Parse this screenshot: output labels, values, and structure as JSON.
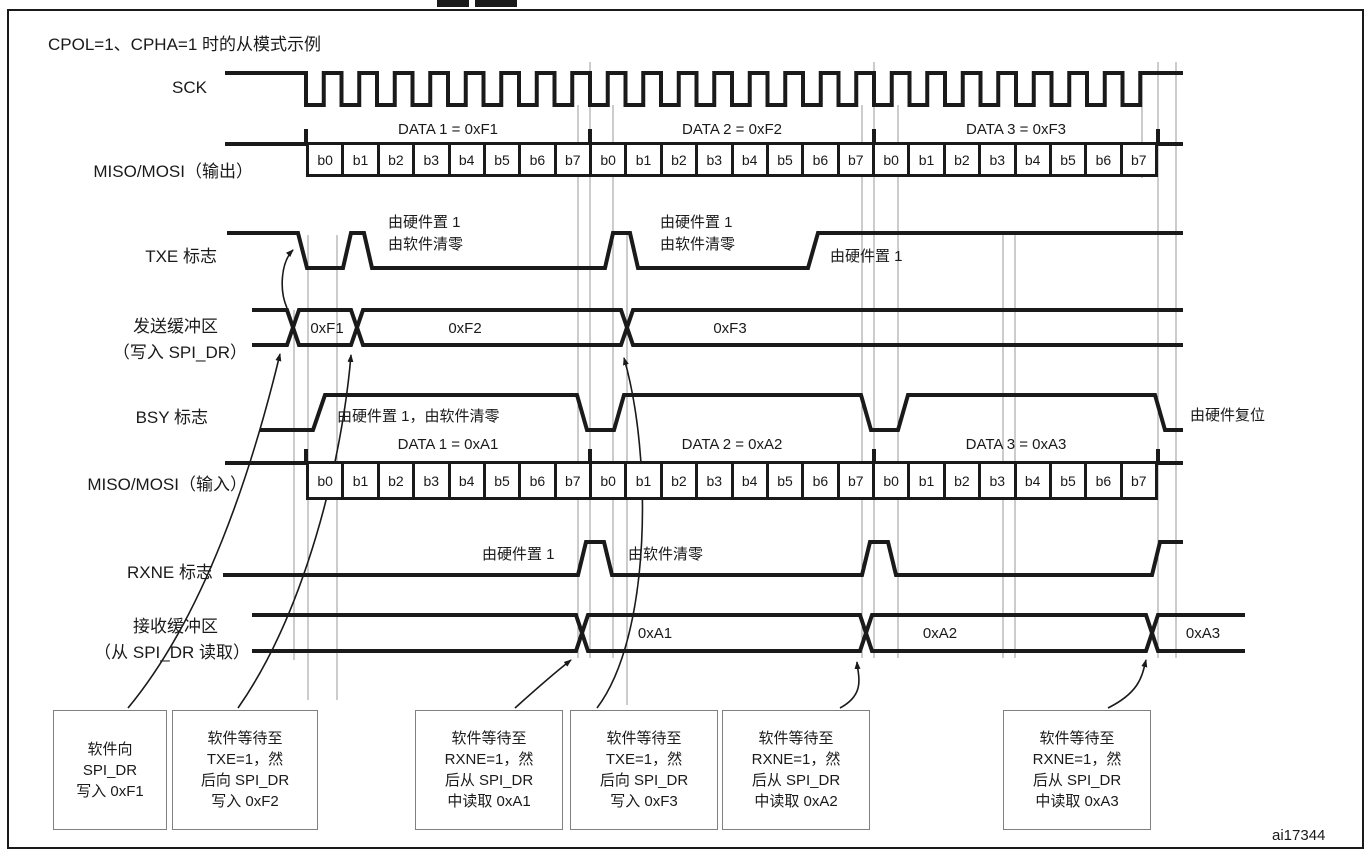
{
  "title": "CPOL=1、CPHA=1 时的从模式示例",
  "figure_code": "ai17344",
  "bits": [
    "b0",
    "b1",
    "b2",
    "b3",
    "b4",
    "b5",
    "b6",
    "b7"
  ],
  "rows": {
    "sck": {
      "label": "SCK"
    },
    "miso_out": {
      "label": "MISO/MOSI（输出）",
      "groups": [
        "DATA 1 = 0xF1",
        "DATA 2 = 0xF2",
        "DATA 3 = 0xF3"
      ]
    },
    "txe": {
      "label": "TXE 标志",
      "ann_set1_line1": "由硬件置 1",
      "ann_set1_line2": "由软件清零",
      "ann_set2_line1": "由硬件置 1",
      "ann_set2_line2": "由软件清零",
      "ann_set3": "由硬件置 1"
    },
    "tx_buffer": {
      "label_line1": "发送缓冲区",
      "label_line2": "（写入 SPI_DR）",
      "values": [
        "0xF1",
        "0xF2",
        "0xF3"
      ]
    },
    "bsy": {
      "label": "BSY 标志",
      "ann1": "由硬件置 1，由软件清零",
      "ann2": "由硬件复位"
    },
    "miso_in": {
      "label": "MISO/MOSI（输入）",
      "groups": [
        "DATA 1 = 0xA1",
        "DATA 2 = 0xA2",
        "DATA 3 = 0xA3"
      ]
    },
    "rxne": {
      "label": "RXNE 标志",
      "ann1": "由硬件置 1",
      "ann2": "由软件清零"
    },
    "rx_buffer": {
      "label_line1": "接收缓冲区",
      "label_line2": "（从 SPI_DR 读取）",
      "values": [
        "0xA1",
        "0xA2",
        "0xA3"
      ]
    }
  },
  "callouts": [
    {
      "lines": [
        "软件向",
        "SPI_DR",
        "写入 0xF1"
      ]
    },
    {
      "lines": [
        "软件等待至",
        "TXE=1，然",
        "后向 SPI_DR",
        "写入 0xF2"
      ]
    },
    {
      "lines": [
        "软件等待至",
        "RXNE=1，然",
        "后从 SPI_DR",
        "中读取 0xA1"
      ]
    },
    {
      "lines": [
        "软件等待至",
        "TXE=1，然",
        "后向 SPI_DR",
        "写入 0xF3"
      ]
    },
    {
      "lines": [
        "软件等待至",
        "RXNE=1，然",
        "后从 SPI_DR",
        "中读取 0xA2"
      ]
    },
    {
      "lines": [
        "软件等待至",
        "RXNE=1，然",
        "后从 SPI_DR",
        "中读取 0xA3"
      ]
    }
  ]
}
